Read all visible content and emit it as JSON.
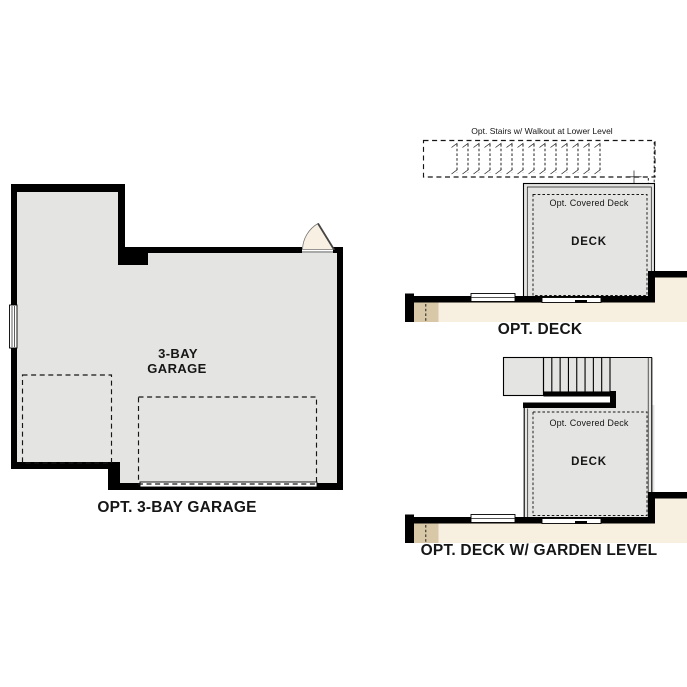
{
  "colors": {
    "wall": "#000000",
    "floor": "#e4e4e2",
    "beige": "#f7f0e1",
    "tan": "#d8c8a8",
    "door": "#f8f1e3",
    "text": "#161616"
  },
  "garage": {
    "room_label_line1": "3-BAY",
    "room_label_line2": "GARAGE",
    "caption": "OPT. 3-BAY GARAGE"
  },
  "deck": {
    "stairs_label": "Opt. Stairs w/ Walkout at Lower Level",
    "covered_label": "Opt. Covered Deck",
    "room_label": "DECK",
    "caption": "OPT. DECK"
  },
  "garden_deck": {
    "covered_label": "Opt. Covered Deck",
    "room_label": "DECK",
    "caption": "OPT. DECK W/ GARDEN LEVEL"
  },
  "stairs": {
    "dashed_tread_count": 14,
    "solid_tread_count": 7
  }
}
